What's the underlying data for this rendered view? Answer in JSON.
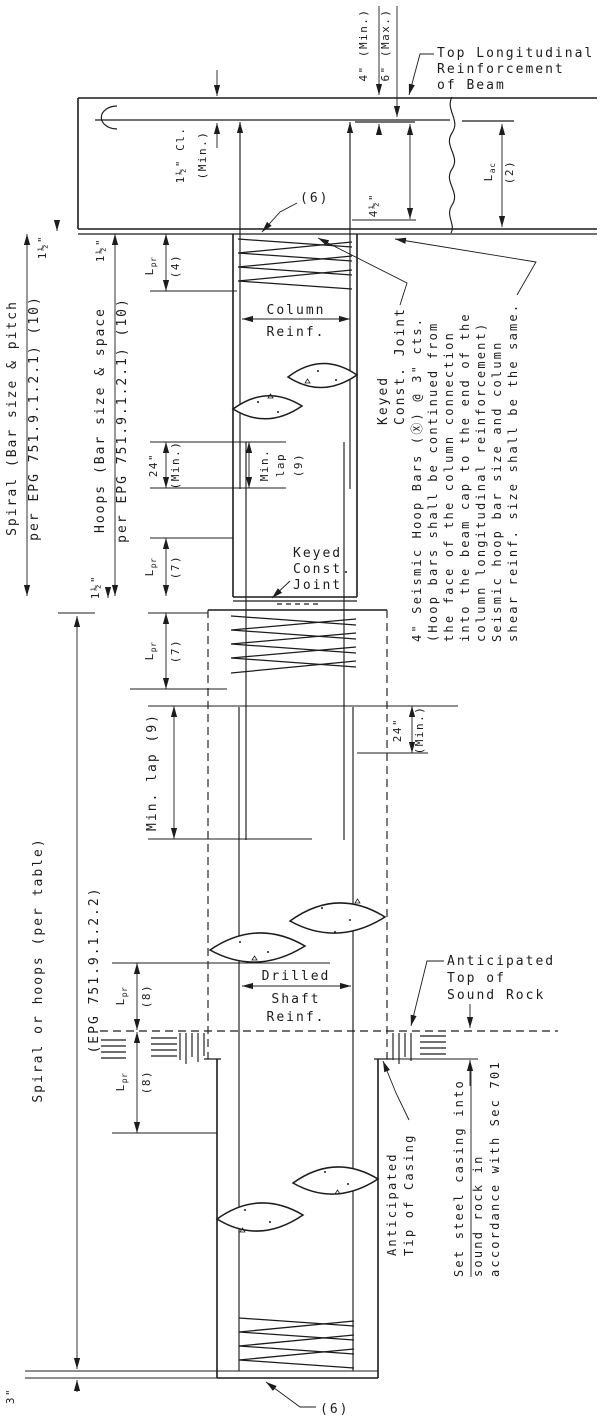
{
  "beam": {
    "top_reinforcement": [
      "Top Longitudinal",
      "Reinforcement",
      "of Beam"
    ],
    "clearance": [
      "1½\" Cl.",
      "(Min.)"
    ],
    "embed_min": "4\" (Min.)",
    "embed_max": "6\" (Max.)",
    "hook_dim": "4½\"",
    "lac_base": "L",
    "lac_sub": "ac",
    "lac_ref": "(2)"
  },
  "column": {
    "reinf": [
      "Column",
      "Reinf."
    ],
    "spiral_callout": "(6)",
    "keyed_joint_vertical": [
      "Keyed",
      "Const. Joint"
    ],
    "keyed_joint_horizontal": [
      "Keyed",
      "Const.",
      "Joint"
    ],
    "min_lap": [
      "Min.",
      "lap",
      "(9)"
    ],
    "lap_24": [
      "24\"",
      "(Min.)"
    ]
  },
  "left_annotations": {
    "spiral": [
      "Spiral (Bar size & pitch",
      "per EPG 751.9.1.2.1) (10)"
    ],
    "hoops": [
      "Hoops (Bar size & space",
      "per EPG 751.9.1.2.1) (10)"
    ],
    "spiral_or_hoops": [
      "Spiral or hoops (per table)",
      "(EPG 751.9.1.2.2)"
    ],
    "lpr_base": "L",
    "lpr_sub": "pr",
    "ref_4": "(4)",
    "ref_7": "(7)",
    "ref_8": "(8)",
    "dim_half": "1½\"",
    "dim_three": "3\""
  },
  "shaft": {
    "reinf": [
      "Drilled",
      "Shaft",
      "Reinf."
    ],
    "min_lap": "Min. lap (9)",
    "lap_24": [
      "24\"",
      "(Min.)"
    ],
    "spiral_callout": "(6)"
  },
  "notes": {
    "seismic": [
      "4\" Seismic Hoop Bars (Ⓧ) @ 3\" cts.",
      "(Hoop bars shall be continued from",
      "the face of the column connection",
      "into the beam cap to the end of the",
      "column longitudinal reinforcement)",
      "Seismic hoop bar size and column",
      "shear reinf. size shall be the same."
    ],
    "sound_rock": [
      "Anticipated",
      "Top of",
      "Sound Rock"
    ],
    "tip_of_casing": [
      "Anticipated",
      "Tip of Casing"
    ],
    "set_casing": [
      "Set steel casing into",
      "sound rock in",
      "accordance with Sec 701"
    ]
  },
  "colors": {
    "ink": "#1c1c1c",
    "paper": "#ffffff"
  }
}
